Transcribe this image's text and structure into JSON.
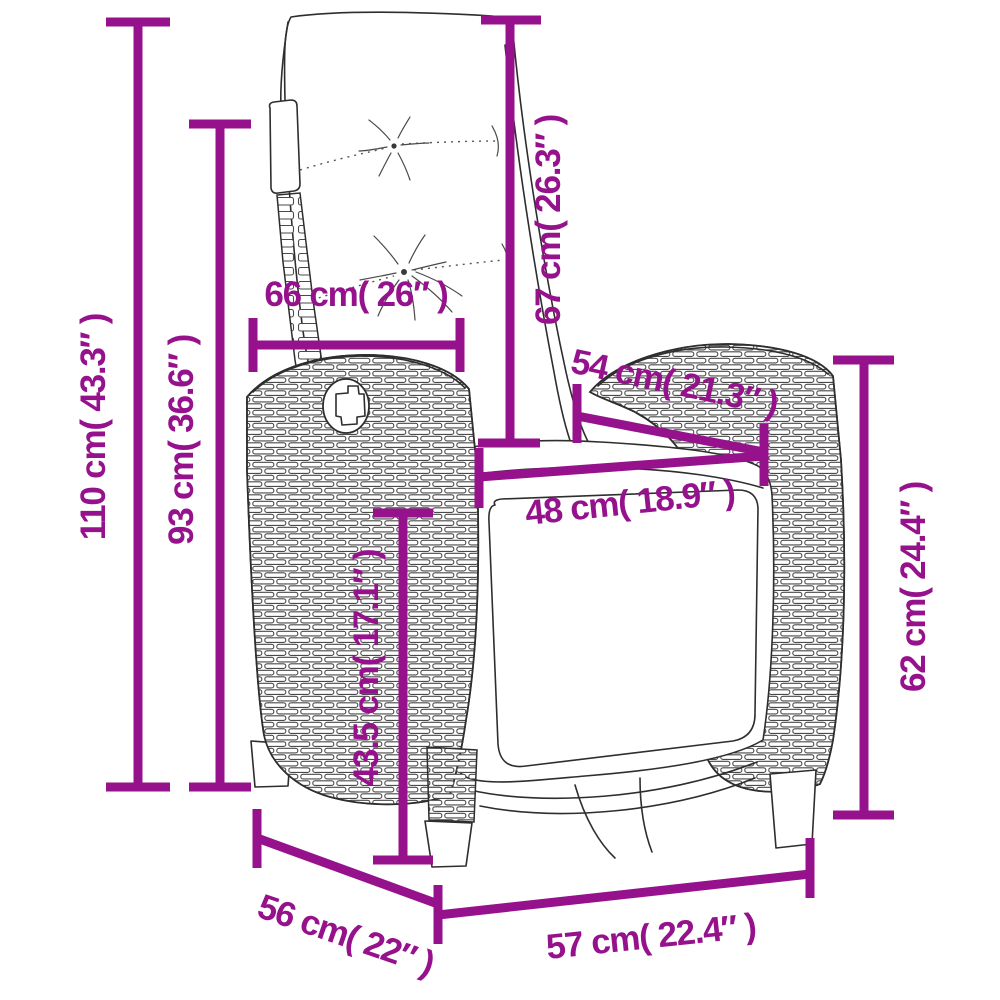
{
  "accent_color": "#96128C",
  "dimensions": {
    "total_height": {
      "label": "110 cm( 43.3″ )"
    },
    "backrest_height": {
      "label": "93 cm( 36.6″ )"
    },
    "back_cushion_width": {
      "label": "66 cm( 26″ )"
    },
    "back_cushion_height": {
      "label": "67 cm( 26.3″ )"
    },
    "seat_depth_diagonal": {
      "label": "54 cm( 21.3″ )"
    },
    "seat_width": {
      "label": "48 cm( 18.9″ )"
    },
    "armrest_height": {
      "label": "62 cm( 24.4″ )"
    },
    "seat_height": {
      "label": "43.5 cm( 17.1″ )"
    },
    "side_depth": {
      "label": "56 cm( 22″ )"
    },
    "front_width": {
      "label": "57 cm( 22.4″ )"
    }
  }
}
